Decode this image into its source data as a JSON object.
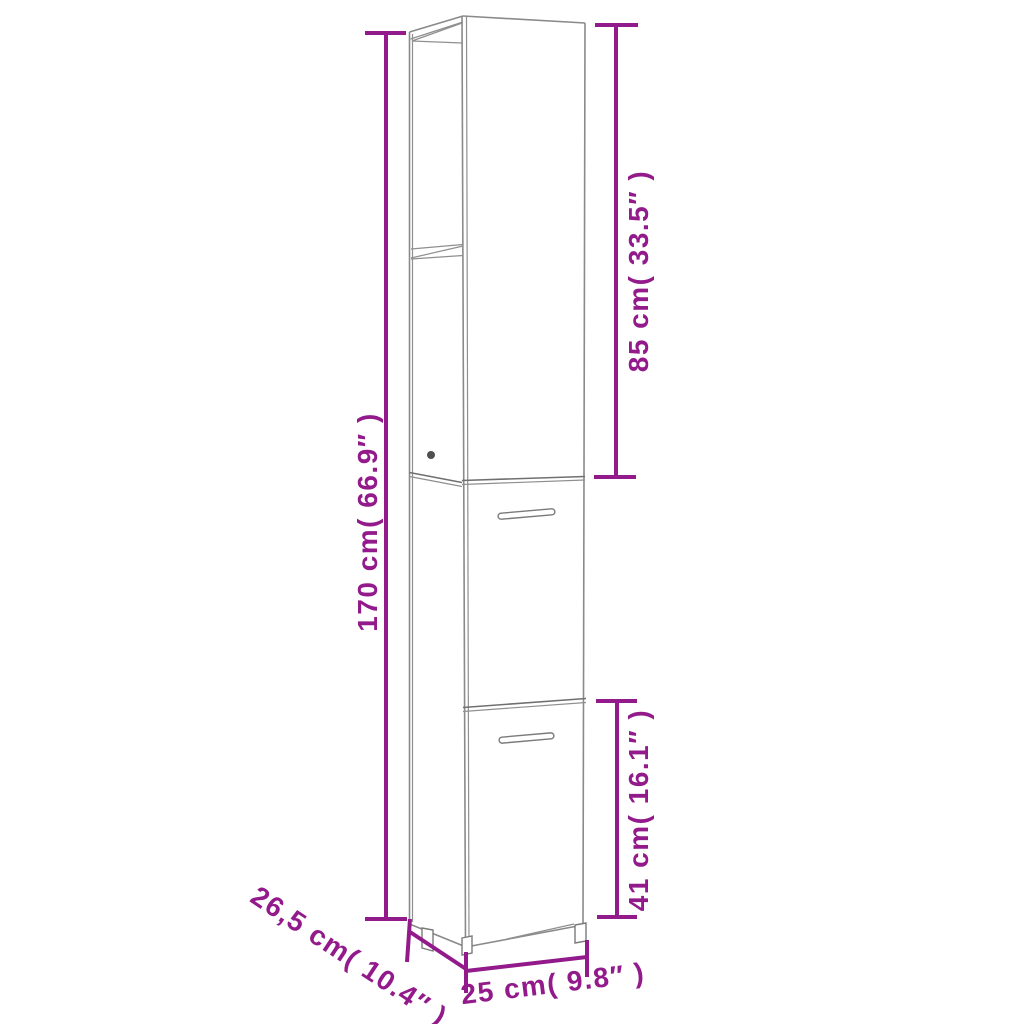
{
  "title": "Bathroom cabinet dimension diagram",
  "colors": {
    "dimension_lines": "#921a8b",
    "cabinet_outline": "#8a8a8a",
    "background": "#ffffff"
  },
  "cabinet": {
    "description": "Tall narrow cabinet line drawing: open upper shelf section, two lower doors with handles, small feet",
    "parts": [
      "open-shelf-top-section",
      "upper-door",
      "lower-door",
      "handles",
      "feet"
    ]
  },
  "dimensions": {
    "total_height": {
      "label": "170 cm( 66.9″ )",
      "cm": "170",
      "inches": "66.9"
    },
    "upper_section_height": {
      "label": "85 cm( 33.5″ )",
      "cm": "85",
      "inches": "33.5"
    },
    "lower_door_height": {
      "label": "41 cm( 16.1″ )",
      "cm": "41",
      "inches": "16.1"
    },
    "depth": {
      "label": "26,5 cm( 10.4″ )",
      "cm": "26,5",
      "inches": "10.4"
    },
    "width": {
      "label": "25 cm( 9.8″ )",
      "cm": "25",
      "inches": "9.8"
    }
  }
}
